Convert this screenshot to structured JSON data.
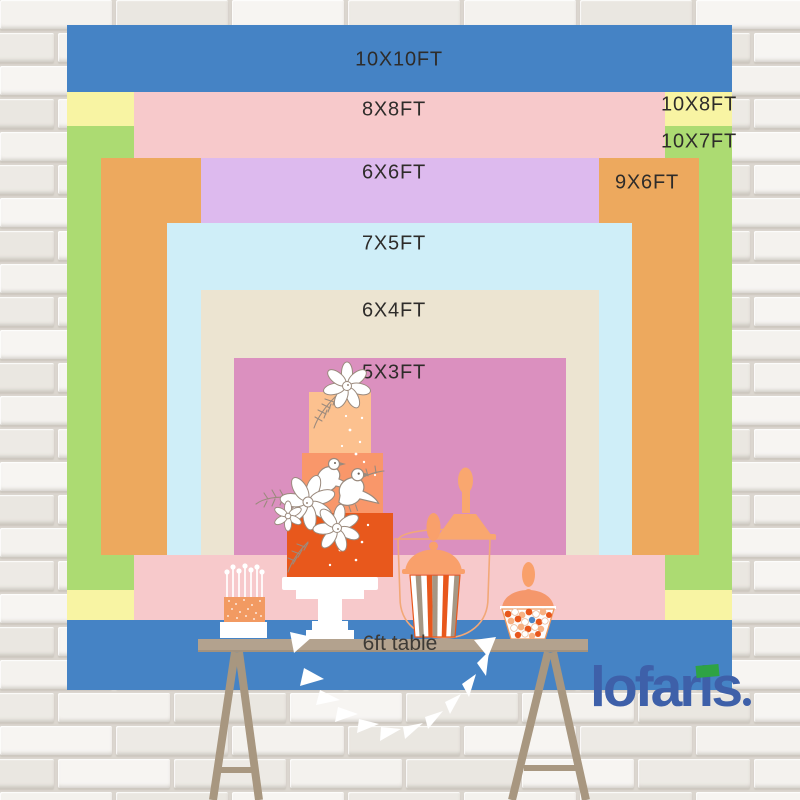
{
  "backdrop": {
    "label_color": "#2e2c2a",
    "layers": [
      {
        "name": "10x10ft",
        "label": "10X10FT",
        "w_ft": 10,
        "h_ft": 10,
        "color": "#4583c5",
        "rect": [
          67,
          25,
          665,
          665
        ],
        "label_pos": [
          399,
          60
        ]
      },
      {
        "name": "10x8ft",
        "label": "10X8FT",
        "w_ft": 10,
        "h_ft": 8,
        "color": "#f8f4a3",
        "rect": [
          67,
          92,
          665,
          528
        ],
        "label_pos": [
          699,
          105
        ]
      },
      {
        "name": "10x7ft",
        "label": "10X7FT",
        "w_ft": 10,
        "h_ft": 7,
        "color": "#acdb72",
        "rect": [
          67,
          126,
          665,
          464
        ],
        "label_pos": [
          699,
          142
        ]
      },
      {
        "name": "8x8ft",
        "label": "8X8FT",
        "w_ft": 8,
        "h_ft": 8,
        "color": "#f7c9cb",
        "rect": [
          134,
          92,
          531,
          528
        ],
        "label_pos": [
          394,
          110
        ]
      },
      {
        "name": "9x6ft",
        "label": "9X6FT",
        "w_ft": 9,
        "h_ft": 6,
        "color": "#eda95e",
        "rect": [
          101,
          158,
          598,
          397
        ],
        "label_pos": [
          647,
          183
        ]
      },
      {
        "name": "6x6ft",
        "label": "6X6FT",
        "w_ft": 6,
        "h_ft": 6,
        "color": "#ddbaee",
        "rect": [
          201,
          158,
          398,
          397
        ],
        "label_pos": [
          394,
          173
        ]
      },
      {
        "name": "7x5ft",
        "label": "7X5FT",
        "w_ft": 7,
        "h_ft": 5,
        "color": "#cfeef8",
        "rect": [
          167,
          223,
          465,
          332
        ],
        "label_pos": [
          394,
          244
        ]
      },
      {
        "name": "6x4ft",
        "label": "6X4FT",
        "w_ft": 6,
        "h_ft": 4,
        "color": "#ece4d1",
        "rect": [
          201,
          290,
          398,
          265
        ],
        "label_pos": [
          394,
          311
        ]
      },
      {
        "name": "5x3ft",
        "label": "5X3FT",
        "w_ft": 5,
        "h_ft": 3,
        "color": "#db90bf",
        "rect": [
          234,
          358,
          332,
          197
        ],
        "label_pos": [
          394,
          373
        ]
      }
    ]
  },
  "table": {
    "label": "6ft table",
    "label_color": "#3d3a36",
    "top_color": "#b3a28e",
    "leg_color": "#a89780"
  },
  "brand": {
    "name": "lofaris",
    "color": "#3e60a9",
    "flag_icon": "green-flag",
    "flag_color": "#2ea344"
  }
}
